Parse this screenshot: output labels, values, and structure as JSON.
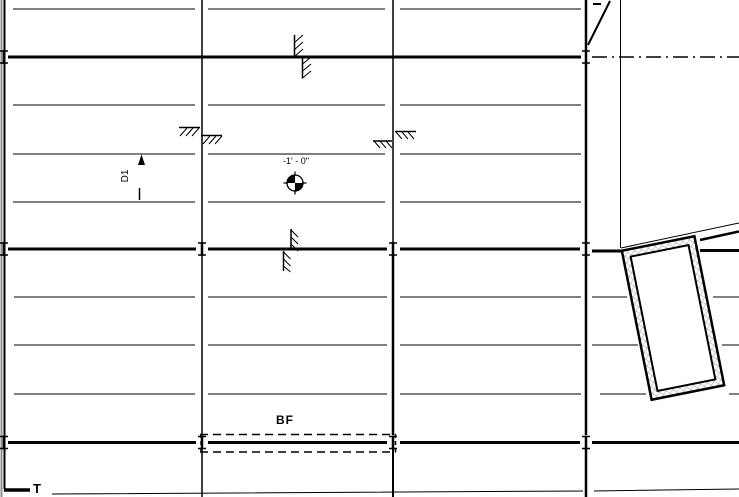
{
  "viewport": {
    "type": "structural-framing-plan-cad-view",
    "description": "Black-and-white CAD framing plan: thin joist lines, thick girder lines with connection ticks, column grid lines, step hatch symbols, rotated double-wall shaft at right"
  },
  "labels": {
    "deck_span": "D1",
    "spot_elevation": "-1' - 0\"",
    "braced_frame": "BF",
    "edge_label": "T"
  },
  "symbols": [
    "spot-elevation-target",
    "deck-span-arrow",
    "braced-frame-dashed-envelope",
    "step-hatch-marks",
    "beam-connection-ticks",
    "rotated-shaft-walls",
    "centerline-dash-dot"
  ],
  "colors": {
    "line": "#000000",
    "viewport_edge": "#8f8f8f",
    "wall_hatch": "#b8b8b8",
    "background": "#ffffff"
  }
}
